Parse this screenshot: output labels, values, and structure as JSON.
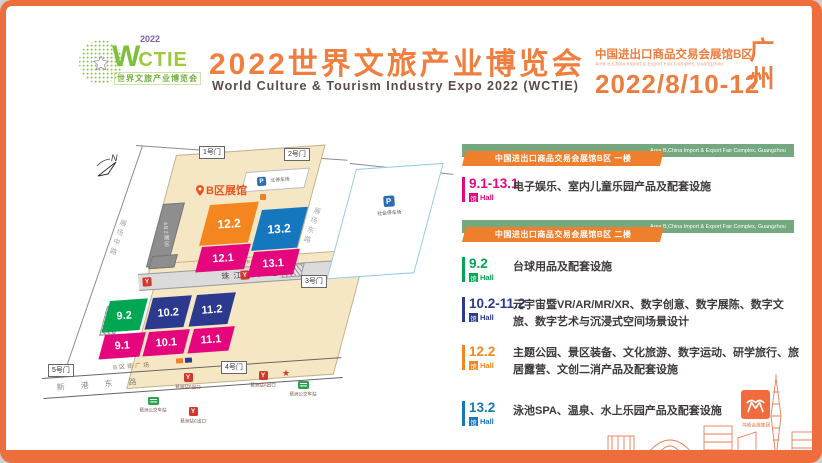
{
  "header": {
    "logo": {
      "acronym_w": "W",
      "acronym_rest": "CTIE",
      "year": "2022",
      "tagline": "世界文旅产业博览会"
    },
    "title": "2022世界文旅产业博览会",
    "subtitle": "World Culture & Tourism Industry Expo 2022 (WCTIE)",
    "venue_cn": "中国进出口商品交易会展馆B区",
    "venue_en": "Area B,China Import & Export Fair Complex, Guangzhou",
    "dates": "2022/8/10-12",
    "city_line1": "广",
    "city_line2": "州"
  },
  "map": {
    "compass_label": "N",
    "area_label": "B区展馆",
    "building_label": "4B2展区",
    "south_square": "B区南广场",
    "gates": [
      {
        "label": "1号门"
      },
      {
        "label": "2号门"
      },
      {
        "label": "3号门"
      },
      {
        "label": "4号门"
      },
      {
        "label": "5号门"
      }
    ],
    "roads": [
      {
        "label": "展场中路"
      },
      {
        "label": "展场东路"
      },
      {
        "label": "卡车通道"
      },
      {
        "label": "珠江散步道"
      },
      {
        "label": "新港东路"
      }
    ],
    "parking": [
      {
        "label": "北停车场"
      },
      {
        "label": "社会停车场"
      }
    ],
    "halls": [
      {
        "label": "12.2",
        "color": "#F5861F"
      },
      {
        "label": "13.2",
        "color": "#1577BE"
      },
      {
        "label": "12.1",
        "color": "#E5067E"
      },
      {
        "label": "13.1",
        "color": "#E5067E"
      },
      {
        "label": "9.2",
        "color": "#00A651"
      },
      {
        "label": "10.2",
        "color": "#2B3A8F"
      },
      {
        "label": "11.2",
        "color": "#2B3A8F"
      },
      {
        "label": "9.1",
        "color": "#E5067E"
      },
      {
        "label": "10.1",
        "color": "#E5067E"
      },
      {
        "label": "11.1",
        "color": "#E5067E"
      }
    ],
    "transit": [
      {
        "type": "metro",
        "label": "琶洲站B出口"
      },
      {
        "type": "metro",
        "label": "琶洲站A出口"
      },
      {
        "type": "metro",
        "label": "琶洲站C出口"
      },
      {
        "type": "bus",
        "label": "琶洲公交车站"
      },
      {
        "type": "bus",
        "label": "琶洲公交车站"
      }
    ]
  },
  "legend": {
    "hall_unit_cn": "馆",
    "hall_unit_en": "Hall",
    "sections": [
      {
        "bar_en": "Area B,China Import & Export Fair Complex, Guangzhou",
        "badge": "中国进出口商品交易会展馆B区 一楼"
      },
      {
        "bar_en": "Area B,China Import & Export Fair Complex, Guangzhou",
        "badge": "中国进出口商品交易会展馆B区 二楼"
      }
    ],
    "entries": [
      {
        "hall": "9.1-13.1",
        "color": "#E5067E",
        "desc": "电子娱乐、室内儿童乐园产品及配套设施"
      },
      {
        "hall": "9.2",
        "color": "#00A651",
        "desc": "台球用品及配套设施"
      },
      {
        "hall": "10.2-11.2",
        "color": "#2B3A8F",
        "desc": "元宇宙暨VR/AR/MR/XR、数字创意、数字展陈、数字文旅、数字艺术与沉浸式空间场景设计"
      },
      {
        "hall": "12.2",
        "color": "#F5861F",
        "desc": "主题公园、景区装备、文化旅游、数字运动、研学旅行、旅居露营、文创二消产品及配套设施"
      },
      {
        "hall": "13.2",
        "color": "#1577BE",
        "desc": "泳池SPA、温泉、水上乐园产品及配套设施"
      }
    ]
  },
  "footer": {
    "organizer": "鸿威会展集团"
  }
}
